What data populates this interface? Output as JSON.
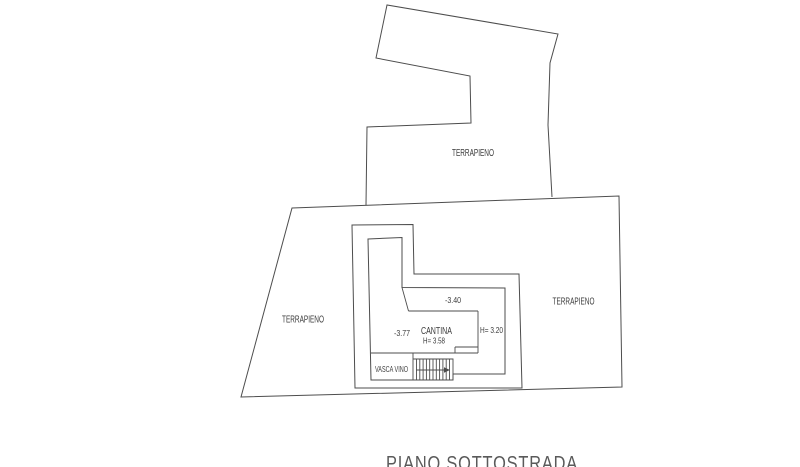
{
  "plan": {
    "title": "PIANO SOTTOSTRADA",
    "labels": {
      "terrapieno_top": "TERRAPIENO",
      "terrapieno_left": "TERRAPIENO",
      "terrapieno_right": "TERRAPIENO",
      "level_upper": "-3.40",
      "level_cantina": "-3.77",
      "room_cantina": "CANTINA",
      "height_cantina": "H= 3.58",
      "height_right": "H= 3.20",
      "room_vasca_vino": "VASCA VINO"
    },
    "colors": {
      "line": "#4d4d4d",
      "label": "#3b3b3b",
      "title": "#5a5a5a",
      "background": "#ffffff"
    }
  }
}
